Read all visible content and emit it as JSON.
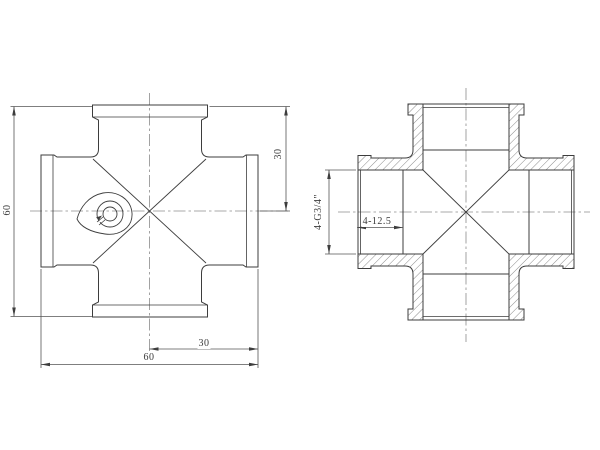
{
  "drawing": {
    "description": "Two-view engineering drawing of a 4-way cross pipe fitting: front view (left) and hatched cross-section view (right)",
    "colors": {
      "background": "#ffffff",
      "object_line": "#3d3d3d",
      "thin_line": "#555555",
      "centerline": "#8c8c8c",
      "hatch_line": "#5a5a5a",
      "text": "#3a3a3a"
    },
    "dimensions": {
      "front_height": {
        "value": "60"
      },
      "front_half_height": {
        "value": "30"
      },
      "front_half_width": {
        "value": "30"
      },
      "front_width": {
        "value": "60"
      },
      "section_thread": {
        "value": "4-G3/4\""
      },
      "section_depth": {
        "value": "4-12.5"
      }
    }
  }
}
